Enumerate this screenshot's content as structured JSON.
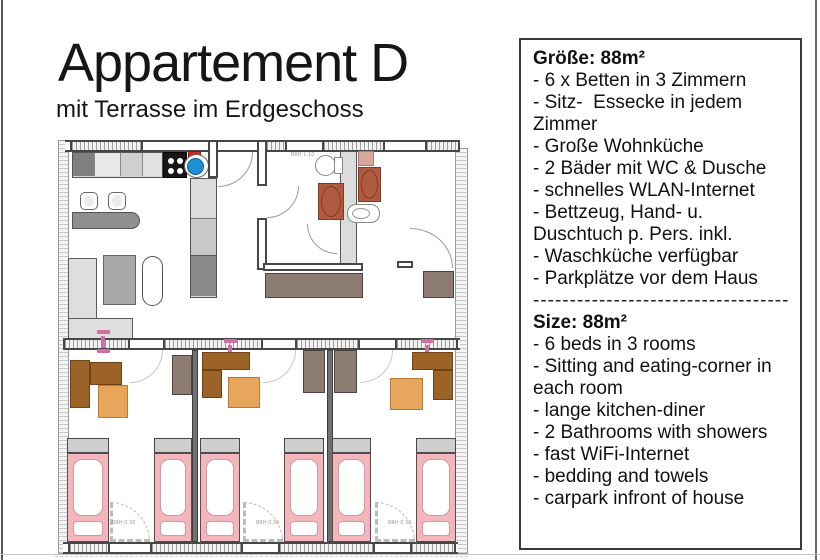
{
  "header": {
    "title": "Appartement D",
    "subtitle": "mit Terrasse im Erdgeschoss"
  },
  "info_panel": {
    "german": {
      "heading": "Größe: 88m²",
      "items": [
        "- 6 x Betten in 3 Zimmern",
        "- Sitz-  Essecke in jedem Zimmer",
        "- Große Wohnküche",
        "- 2 Bäder mit WC & Dusche",
        "- schnelles WLAN-Internet",
        "- Bettzeug, Hand- u. Duschtuch p. Pers. inkl.",
        "- Waschküche verfügbar",
        "- Parkplätze vor dem Haus"
      ]
    },
    "divider": "--------------------------------------------------",
    "english": {
      "heading": "Size: 88m²",
      "items": [
        "- 6 beds in 3 rooms",
        "- Sitting and eating-corner in each room",
        "- lange kitchen-diner",
        "- 2 Bathrooms with showers",
        "- fast WiFi-Internet",
        "- bedding and towels",
        "- carpark infront of house"
      ]
    }
  },
  "floorplan": {
    "window_label": "BRH 1.10",
    "door_labels": [
      "BRH 0.30",
      "BRH 0.30",
      "BRH 0.30"
    ],
    "colors": {
      "bed_pink": "#f2b6bc",
      "pillow_gray": "#cecece",
      "desk_brown": "#9b6327",
      "table_orange": "#e8a55c",
      "wardrobe_taupe": "#8d7c72",
      "shower_terracotta": "#b05a40",
      "sink_blue": "#1e8fd4",
      "appliance_red": "#d92222",
      "lamp_pink": "#d06fa0",
      "sofa_gray": "#dedede"
    }
  }
}
